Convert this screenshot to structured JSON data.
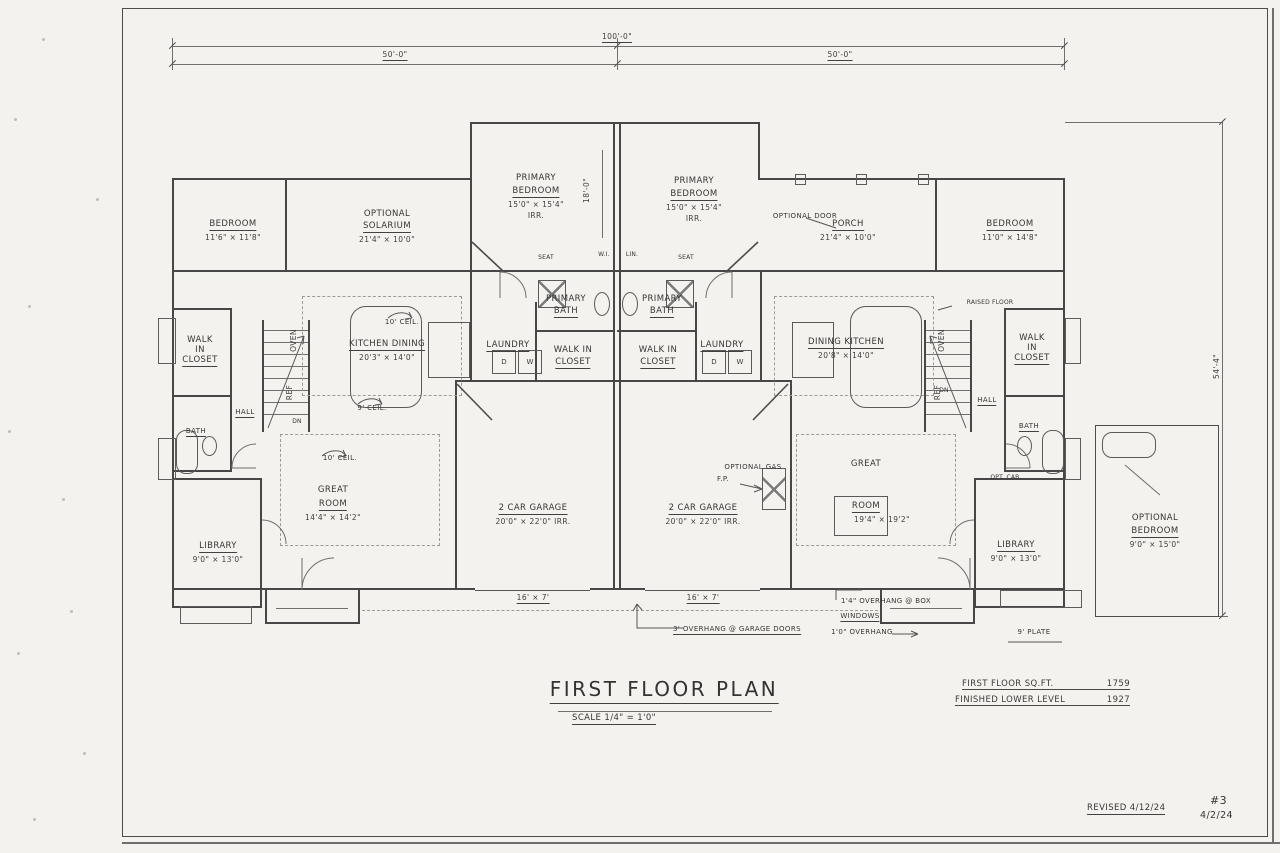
{
  "dims": {
    "overall": "100'-0\"",
    "left_half": "50'-0\"",
    "right_half": "50'-0\"",
    "depth": "54'-4\"",
    "center_depth": "18'-0\"",
    "garage_door": "16' × 7'",
    "plate": "9' PLATE"
  },
  "notes": {
    "garage_overhang": "3' OVERHANG @ GARAGE DOORS",
    "box_window_line1": "1'4\" OVERHANG @ BOX",
    "box_window_line2": "WINDOWS",
    "box_window_line3": "1'0\" OVERHANG",
    "optional_door": "OPTIONAL DOOR",
    "gas_fp_line1": "OPTIONAL GAS",
    "gas_fp_line2": "F.P.",
    "raised_floor": "RAISED FLOOR",
    "opt_cab": "OPT. CAB."
  },
  "left_unit": {
    "bedroom_name": "BEDROOM",
    "bedroom_dims": "11'6\" × 11'8\"",
    "solarium_line1": "OPTIONAL",
    "solarium_line2": "SOLARIUM",
    "solarium_dims": "21'4\" × 10'0\"",
    "primary_line1": "PRIMARY",
    "primary_line2": "BEDROOM",
    "primary_dims": "15'0\" × 15'4\"",
    "primary_irr": "IRR.",
    "primary_bath_line1": "PRIMARY",
    "primary_bath_line2": "BATH",
    "laundry": "LAUNDRY",
    "dryer": "D",
    "washer": "W",
    "wic_line1": "WALK IN",
    "wic_line2": "CLOSET",
    "wic_far_line1": "WALK",
    "wic_far_line2": "IN",
    "wic_far_line3": "CLOSET",
    "kitchen_name": "KITCHEN DINING",
    "kitchen_dims": "20'3\" × 14'0\"",
    "kitchen_ceil": "10' CEIL.",
    "nine_ceil": "9' CEIL.",
    "great_line1": "GREAT",
    "great_line2": "ROOM",
    "great_dims": "14'4\" × 14'2\"",
    "great_ceil": "10' CEIL.",
    "garage_name": "2 CAR GARAGE",
    "garage_dims": "20'0\" × 22'0\" IRR.",
    "hall": "HALL",
    "bath": "BATH",
    "library_name": "LIBRARY",
    "library_dims": "9'0\" × 13'0\"",
    "seat": "SEAT",
    "wi": "W.I.",
    "dn": "DN",
    "ref": "REF",
    "oven": "OVEN"
  },
  "right_unit": {
    "primary_line1": "PRIMARY",
    "primary_line2": "BEDROOM",
    "primary_dims": "15'0\" × 15'4\"",
    "primary_irr": "IRR.",
    "porch_name": "PORCH",
    "porch_dims": "21'4\" × 10'0\"",
    "bedroom_name": "BEDROOM",
    "bedroom_dims": "11'0\" × 14'8\"",
    "primary_bath_line1": "PRIMARY",
    "primary_bath_line2": "BATH",
    "laundry": "LAUNDRY",
    "dryer": "D",
    "washer": "W",
    "wic_line1": "WALK IN",
    "wic_line2": "CLOSET",
    "wic_far_line1": "WALK",
    "wic_far_line2": "IN",
    "wic_far_line3": "CLOSET",
    "kitchen_name": "DINING KITCHEN",
    "kitchen_dims": "20'8\" × 14'0\"",
    "great_line1": "GREAT",
    "great_line2": "ROOM",
    "great_dims": "19'4\" × 19'2\"",
    "garage_name": "2 CAR GARAGE",
    "garage_dims": "20'0\" × 22'0\" IRR.",
    "hall": "HALL",
    "bath": "BATH",
    "library_name": "LIBRARY",
    "library_dims": "9'0\" × 13'0\"",
    "optbed_line1": "OPTIONAL",
    "optbed_line2": "BEDROOM",
    "optbed_dims": "9'0\" × 15'0\"",
    "seat": "SEAT",
    "lin": "LIN.",
    "dn": "DN",
    "ref": "REF",
    "oven": "OVEN"
  },
  "titleblock": {
    "title": "FIRST FLOOR PLAN",
    "scale": "SCALE 1/4\" = 1'0\"",
    "sqft_label": "FIRST FLOOR SQ.FT.",
    "sqft_value": "1759",
    "lower_label": "FINISHED LOWER LEVEL",
    "lower_value": "1927",
    "revised": "REVISED 4/12/24",
    "sheet_number": "#3",
    "sheet_date": "4/2/24"
  }
}
